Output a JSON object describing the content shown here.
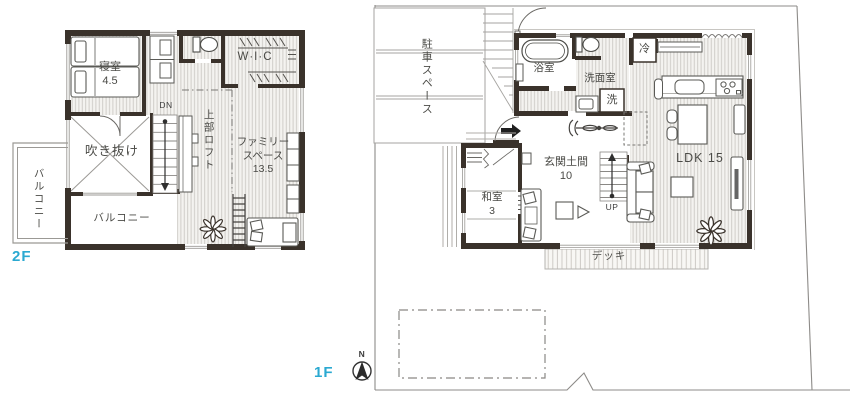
{
  "colors": {
    "accent": "#2BA9D1",
    "wall": "#3A322B",
    "hatch_line": "#ccc9c4",
    "site_line": "#8d8b88"
  },
  "floor2": {
    "floor_label": "2F",
    "bedroom_name": "寝室",
    "bedroom_size": "4.5",
    "wic": "W·I·C",
    "void": "吹き抜け",
    "loft": "上部ロフト",
    "family_line1": "ファミリー",
    "family_line2": "スペース",
    "family_size": "13.5",
    "balcony_left": "バルコニー",
    "balcony_bottom": "バルコニー",
    "stairs_down": "DN"
  },
  "floor1": {
    "floor_label": "1F",
    "parking": "駐車スペース",
    "bath": "浴室",
    "washroom": "洗面室",
    "washer": "洗",
    "fridge": "冷",
    "ldk": "LDK 15",
    "genkan_name": "玄関土間",
    "genkan_size": "10",
    "washitsu_name": "和室",
    "washitsu_size": "3",
    "deck": "デッキ",
    "stairs_up": "UP",
    "compass_north": "N"
  }
}
